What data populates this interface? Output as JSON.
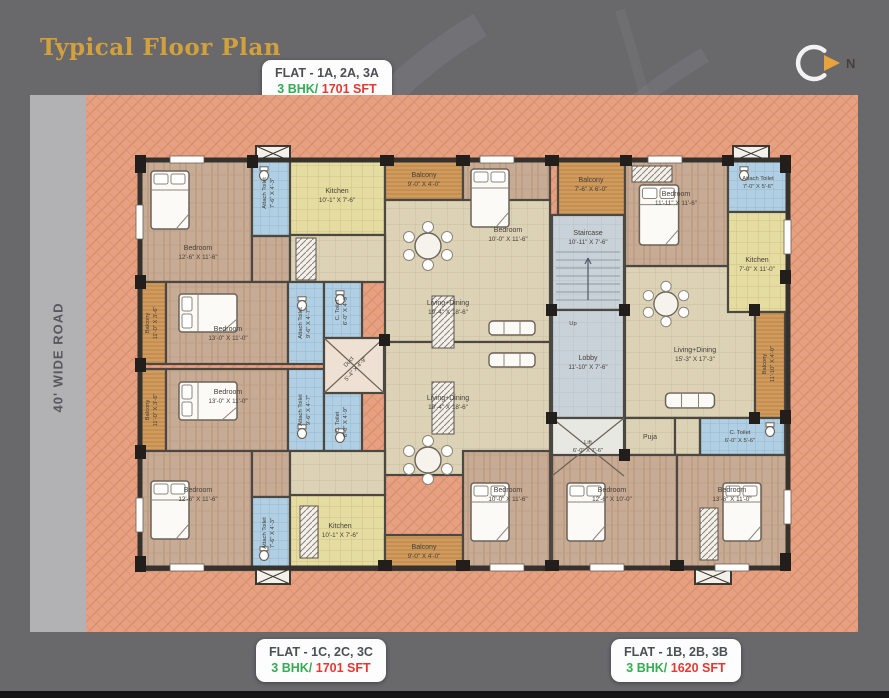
{
  "header": {
    "title": "Typical Floor Plan",
    "north": "N"
  },
  "road": {
    "label": "40' WIDE ROAD"
  },
  "badges": {
    "flat_a": {
      "title": "FLAT - 1A, 2A, 3A",
      "bhk": "3 BHK/",
      "area": "1701 SFT"
    },
    "flat_c": {
      "title": "FLAT - 1C, 2C, 3C",
      "bhk": "3 BHK/",
      "area": "1701 SFT"
    },
    "flat_b": {
      "title": "FLAT - 1B, 2B, 3B",
      "bhk": "3 BHK/",
      "area": "1620 SFT"
    }
  },
  "colors": {
    "background": "#69696c",
    "plan_base": "#e7a081",
    "title_gold": "#d2a03c",
    "bhk_green": "#35ab53",
    "area_red": "#e23935",
    "wall": "#3b3733",
    "toilet_blue": "#b0cfe3",
    "balcony_wood": "#d09b5c",
    "kitchen_yellow": "#e5dca2"
  },
  "plan": {
    "up": "Up",
    "rooms": {
      "a_bed1": {
        "name": "Bedroom",
        "dims": "12'-6\" X 11'-6\""
      },
      "a_toilet1": {
        "name": "Attach Toilet",
        "dims": "7'-6\" X 4'-3\""
      },
      "a_kitchen": {
        "name": "Kitchen",
        "dims": "10'-1\" X 7'-6\""
      },
      "a_balcony1": {
        "name": "Balcony",
        "dims": "9'-0\" X 4'-0\""
      },
      "a_bed2": {
        "name": "Bedroom",
        "dims": "10'-0\" X 11'-6\""
      },
      "a_balcony2": {
        "name": "Balcony",
        "dims": "11'-0\" X 3'-6\""
      },
      "a_bed3": {
        "name": "Bedroom",
        "dims": "13'-0\" X 11'-0\""
      },
      "a_atoilet2": {
        "name": "Attach Toilet",
        "dims": "9'-6\" X 4'-7\""
      },
      "a_ctoilet": {
        "name": "C. Toilet",
        "dims": "6'-0\" X 4'-9\""
      },
      "a_living": {
        "name": "Living+Dining",
        "dims": "19'-4\" X 18'-6\""
      },
      "duct": {
        "name": "Duct",
        "dims": "5'-4\" X 4'-9\""
      },
      "c_balcony1": {
        "name": "Balcony",
        "dims": "11'-0\" X 3'-6\""
      },
      "c_bed1": {
        "name": "Bedroom",
        "dims": "13'-0\" X 11'-0\""
      },
      "c_atoilet1": {
        "name": "Attach Toilet",
        "dims": "9'-6\" X 4'-7\""
      },
      "c_ctoilet": {
        "name": "C. Toilet",
        "dims": "6'-0\" X 4'-9\""
      },
      "c_living": {
        "name": "Living+Dining",
        "dims": "19'-4\" X 18'-6\""
      },
      "c_bed2": {
        "name": "Bedroom",
        "dims": "12'-6\" X 11'-6\""
      },
      "c_atoilet2": {
        "name": "Attach Toilet",
        "dims": "7'-6\" X 4'-3\""
      },
      "c_kitchen": {
        "name": "Kitchen",
        "dims": "10'-1\" X 7'-6\""
      },
      "c_balcony2": {
        "name": "Balcony",
        "dims": "9'-0\" X 4'-0\""
      },
      "c_bed3": {
        "name": "Bedroom",
        "dims": "10'-0\" X 11'-6\""
      },
      "mid_balcony": {
        "name": "Balcony",
        "dims": "7'-6\" X 6'-0\""
      },
      "stair": {
        "name": "Staircase",
        "dims": "10'-11\" X 7'-6\""
      },
      "lobby": {
        "name": "Lobby",
        "dims": "11'-10\" X 7'-6\""
      },
      "lift": {
        "name": "Lift",
        "dims": "6'-0\" X 7'-6\""
      },
      "b_bed1": {
        "name": "Bedroom",
        "dims": "11'-11\" X 11'-6\""
      },
      "b_atoilet": {
        "name": "Attach Toilet",
        "dims": "7'-0\" X 5'-6\""
      },
      "b_kitchen": {
        "name": "Kitchen",
        "dims": "7'-0\" X 11'-0\""
      },
      "b_living": {
        "name": "Living+Dining",
        "dims": "15'-3\" X 17'-3\""
      },
      "b_balcony": {
        "name": "Balcony",
        "dims": "11'-10\" X 4'-0\""
      },
      "b_puja": {
        "name": "Puja",
        "dims": ""
      },
      "b_ctoilet": {
        "name": "C. Toilet",
        "dims": "6'-0\" X 5'-6\""
      },
      "b_bed2": {
        "name": "Bedroom",
        "dims": "12'-6\" X 10'-0\""
      },
      "b_bed3": {
        "name": "Bedroom",
        "dims": "13'-6\" X 11'-0\""
      }
    }
  }
}
